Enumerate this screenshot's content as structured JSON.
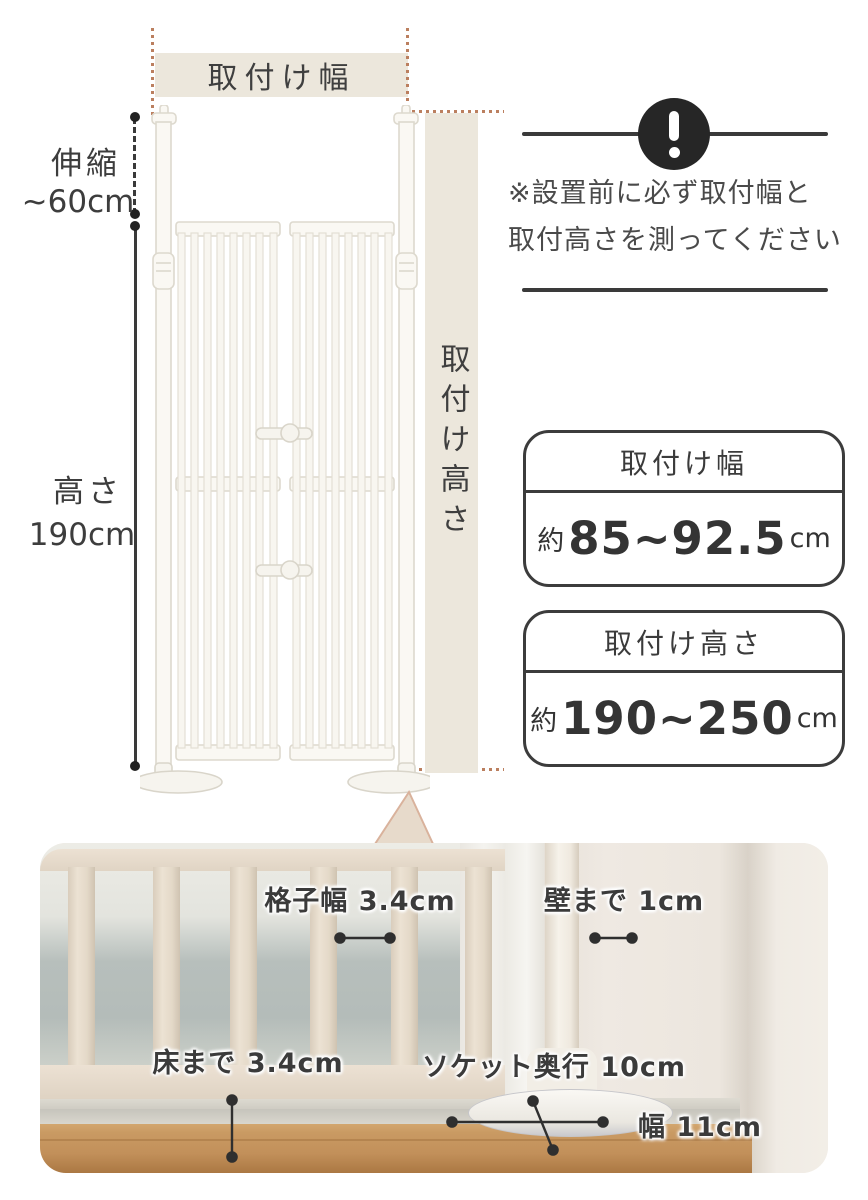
{
  "diagram": {
    "width_bar_label": "取付け幅",
    "height_bar_label": "取付け高さ",
    "extension_label_line1": "伸縮",
    "extension_label_line2": "~60cm",
    "height_label_line1": "高さ",
    "height_label_line2": "190cm"
  },
  "notice": {
    "icon": "exclamation-icon",
    "line1": "※設置前に必ず取付幅と",
    "line2": "取付高さを測ってください"
  },
  "spec_boxes": [
    {
      "title": "取付け幅",
      "prefix": "約",
      "value": "85~92.5",
      "unit": "cm"
    },
    {
      "title": "取付け高さ",
      "prefix": "約",
      "value": "190~250",
      "unit": "cm"
    }
  ],
  "photo_labels": {
    "lattice_width": "格子幅 3.4cm",
    "to_wall": "壁まで 1cm",
    "to_floor": "床まで 3.4cm",
    "socket_depth": "ソケット奥行 10cm",
    "socket_width": "幅 11cm"
  },
  "colors": {
    "beige_band": "#ece7dc",
    "dotted_guide": "#bb7f5f",
    "ink": "#3d3d3d",
    "wood_floor": "#c99a63"
  }
}
